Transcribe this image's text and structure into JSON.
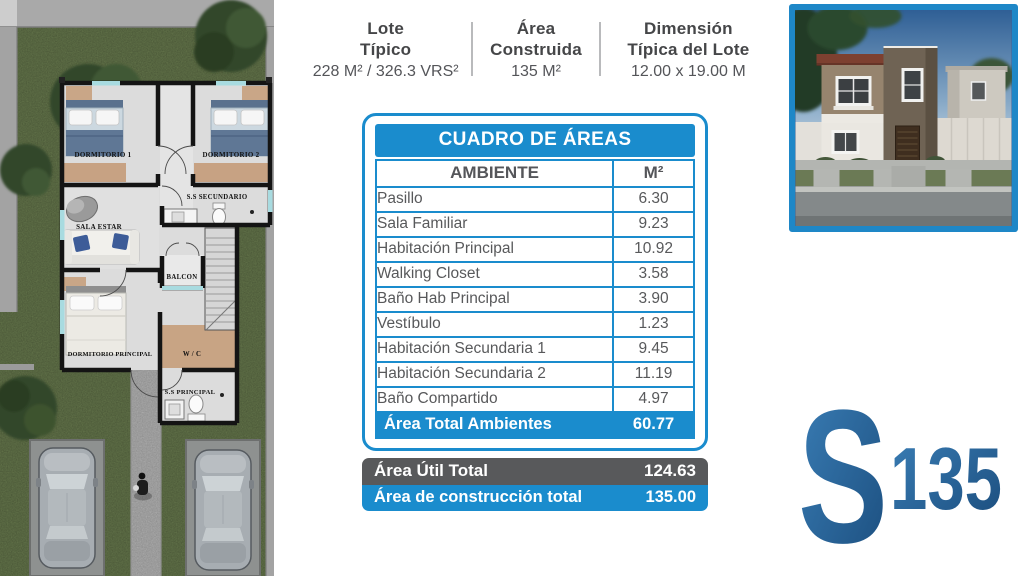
{
  "header": {
    "columns": [
      {
        "title": "Lote\nTípico",
        "title_line1": "Lote",
        "title_line2": "Típico",
        "value": "228 M² / 326.3 VRS²"
      },
      {
        "title": "Área\nConstruida",
        "title_line1": "Área",
        "title_line2": "Construida",
        "value": "135 M²"
      },
      {
        "title": "Dimensión\nTípica del Lote",
        "title_line1": "Dimensión",
        "title_line2": "Típica del Lote",
        "value": "12.00 x 19.00 M"
      }
    ]
  },
  "areas_table": {
    "title": "CUADRO DE ÁREAS",
    "col_headers": {
      "ambiente": "AMBIENTE",
      "m2": "M²"
    },
    "rows": [
      {
        "name": "Pasillo",
        "value": "6.30"
      },
      {
        "name": "Sala Familiar",
        "value": "9.23"
      },
      {
        "name": "Habitación Principal",
        "value": "10.92"
      },
      {
        "name": "Walking Closet",
        "value": "3.58"
      },
      {
        "name": "Baño Hab Principal",
        "value": "3.90"
      },
      {
        "name": "Vestíbulo",
        "value": "1.23"
      },
      {
        "name": "Habitación Secundaria 1",
        "value": "9.45"
      },
      {
        "name": "Habitación Secundaria 2",
        "value": "11.19"
      },
      {
        "name": "Baño Compartido",
        "value": "4.97"
      }
    ],
    "total": {
      "label": "Área Total Ambientes",
      "value": "60.77"
    }
  },
  "summary": {
    "util": {
      "label": "Área Útil Total",
      "value": "124.63"
    },
    "construccion": {
      "label": "Área de construcción total",
      "value": "135.00"
    }
  },
  "floor_plan": {
    "labels": {
      "dormitorio1": "DORMITORIO 1",
      "dormitorio2": "DORMITORIO 2",
      "ss_secundario": "S.S SECUNDARIO",
      "sala_estar": "SALA ESTAR",
      "balcon": "BALCON",
      "dormitorio_principal": "DORMITORIO PRINCIPAL",
      "wc": "W / C",
      "ss_principal": "S.S PRINCIPAL"
    }
  },
  "logo": {
    "letter": "S",
    "number": "135"
  },
  "colors": {
    "accent_blue": "#1a8ccd",
    "dark_gray": "#58595b",
    "logo_blue": "#225e97"
  }
}
